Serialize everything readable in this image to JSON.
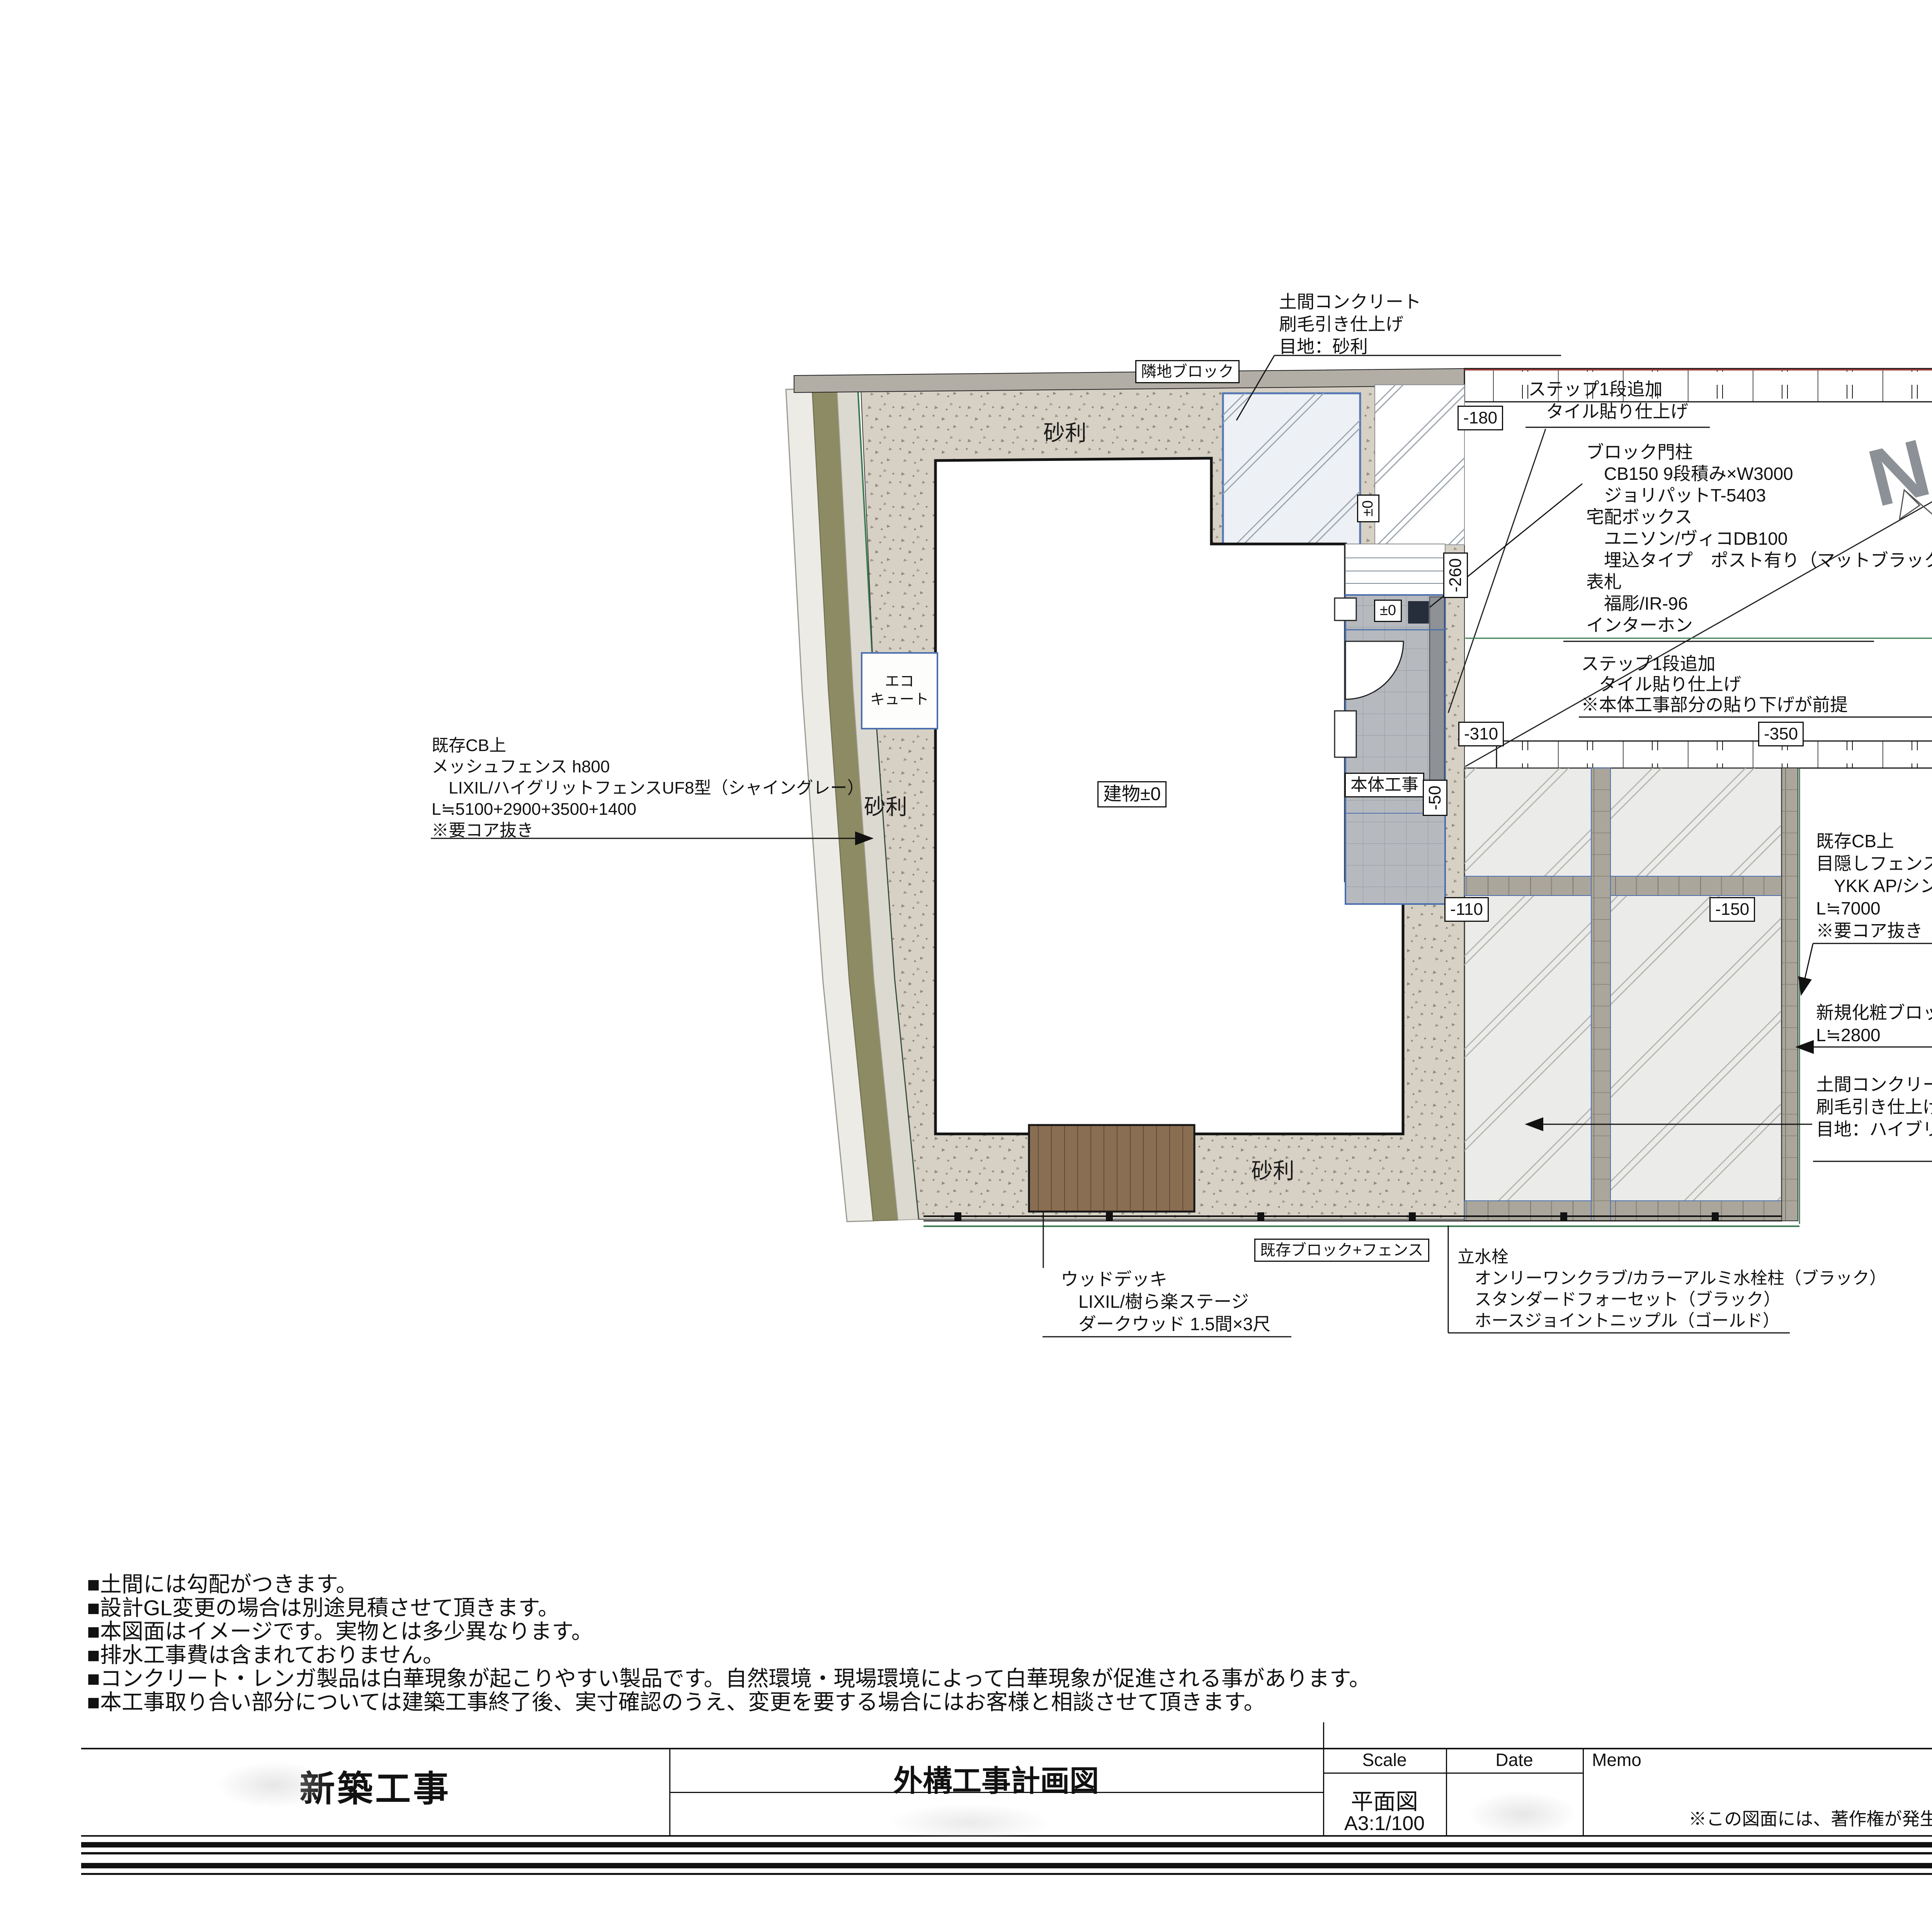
{
  "colors": {
    "pad_border_blue": "#4a6fae",
    "road_planting_olive": "#8d8b63",
    "boundary_red": "#9a3c3c",
    "boundary_green": "#3a7a50",
    "deck_brown": "#8a6e52",
    "post_navy": "#262e3b",
    "north_gray": "#8b9196"
  },
  "plan": {
    "labels": {
      "rinchi_block": "隣地ブロック",
      "gravel": "砂利",
      "building": "建物±0",
      "hontai_kouji": "本体工事",
      "kizon_block_fence": "既存ブロック+フェンス",
      "eco1": "エコ",
      "eco2": "キュート",
      "pm0": "±0",
      "north": "N"
    },
    "levels": {
      "l180": "-180",
      "l260": "-260",
      "l310": "-310",
      "l350": "-350",
      "l400": "-400",
      "l110": "-110",
      "l150": "-150",
      "l50": "-50"
    },
    "annotations": {
      "doma_top": {
        "lines": [
          "土間コンクリート",
          "刷毛引き仕上げ",
          "目地：砂利"
        ]
      },
      "step_add_1": {
        "lines": [
          "ステップ1段追加",
          "　タイル貼り仕上げ"
        ]
      },
      "gate_post": {
        "lines": [
          "ブロック門柱",
          "　CB150 9段積み×W3000",
          "　ジョリパットT-5403",
          "宅配ボックス",
          "　ユニソン/ヴィコDB100",
          "　埋込タイプ　ポスト有り（マットブラック）",
          "表札",
          "　福彫/IR-96",
          "インターホン"
        ]
      },
      "step_add_2": {
        "lines": [
          "ステップ1段追加",
          "　タイル貼り仕上げ",
          "※本体工事部分の貼り下げが前提"
        ]
      },
      "mesh_fence": {
        "lines": [
          "既存CB上",
          "メッシュフェンス h800",
          "　LIXIL/ハイグリットフェンスUF8型（シャイングレー）",
          "L≒5100+2900+3500+1400",
          "※要コア抜き"
        ]
      },
      "privacy_fence": {
        "lines": [
          "既存CB上",
          "目隠しフェンス h800",
          "　YKK AP/シンプレオフェンスYS3型（ブラウン）",
          "L≒7000",
          "※要コア抜き"
        ]
      },
      "new_block": {
        "lines": [
          "新規化粧ブロック120 1段積み",
          "L≒2800"
        ]
      },
      "doma_right": {
        "lines": [
          "土間コンクリート",
          "刷毛引き仕上げ",
          "目地：ハイブリック6 G-2"
        ]
      },
      "wood_deck": {
        "lines": [
          "ウッドデッキ",
          "　LIXIL/樹ら楽ステージ",
          "　ダークウッド 1.5間×3尺"
        ]
      },
      "faucet": {
        "lines": [
          "立水栓",
          "　オンリーワンクラブ/カラーアルミ水栓柱（ブラック）",
          "　スタンダードフォーセット（ブラック）",
          "　ホースジョイントニップル（ゴールド）"
        ]
      }
    }
  },
  "notes": {
    "lines": [
      "■土間には勾配がつきます。",
      "■設計GL変更の場合は別途見積させて頂きます。",
      "■本図面はイメージです。実物とは多少異なります。",
      "■排水工事費は含まれておりません。",
      "■コンクリート・レンガ製品は白華現象が起こりやすい製品です。自然環境・現場環境によって白華現象が促進される事があります。",
      "■本工事取り合い部分については建築工事終了後、実寸確認のうえ、変更を要する場合にはお客様と相談させて頂きます。"
    ]
  },
  "title_block": {
    "project": "新築工事",
    "drawing_title": "外構工事計画図",
    "scale_label": "Scale",
    "date_label": "Date",
    "memo_label": "Memo",
    "scale_type": "平面図",
    "scale_value": "A3:1/100",
    "memo_note": "※この図面には、著作権が発生いたします。"
  }
}
